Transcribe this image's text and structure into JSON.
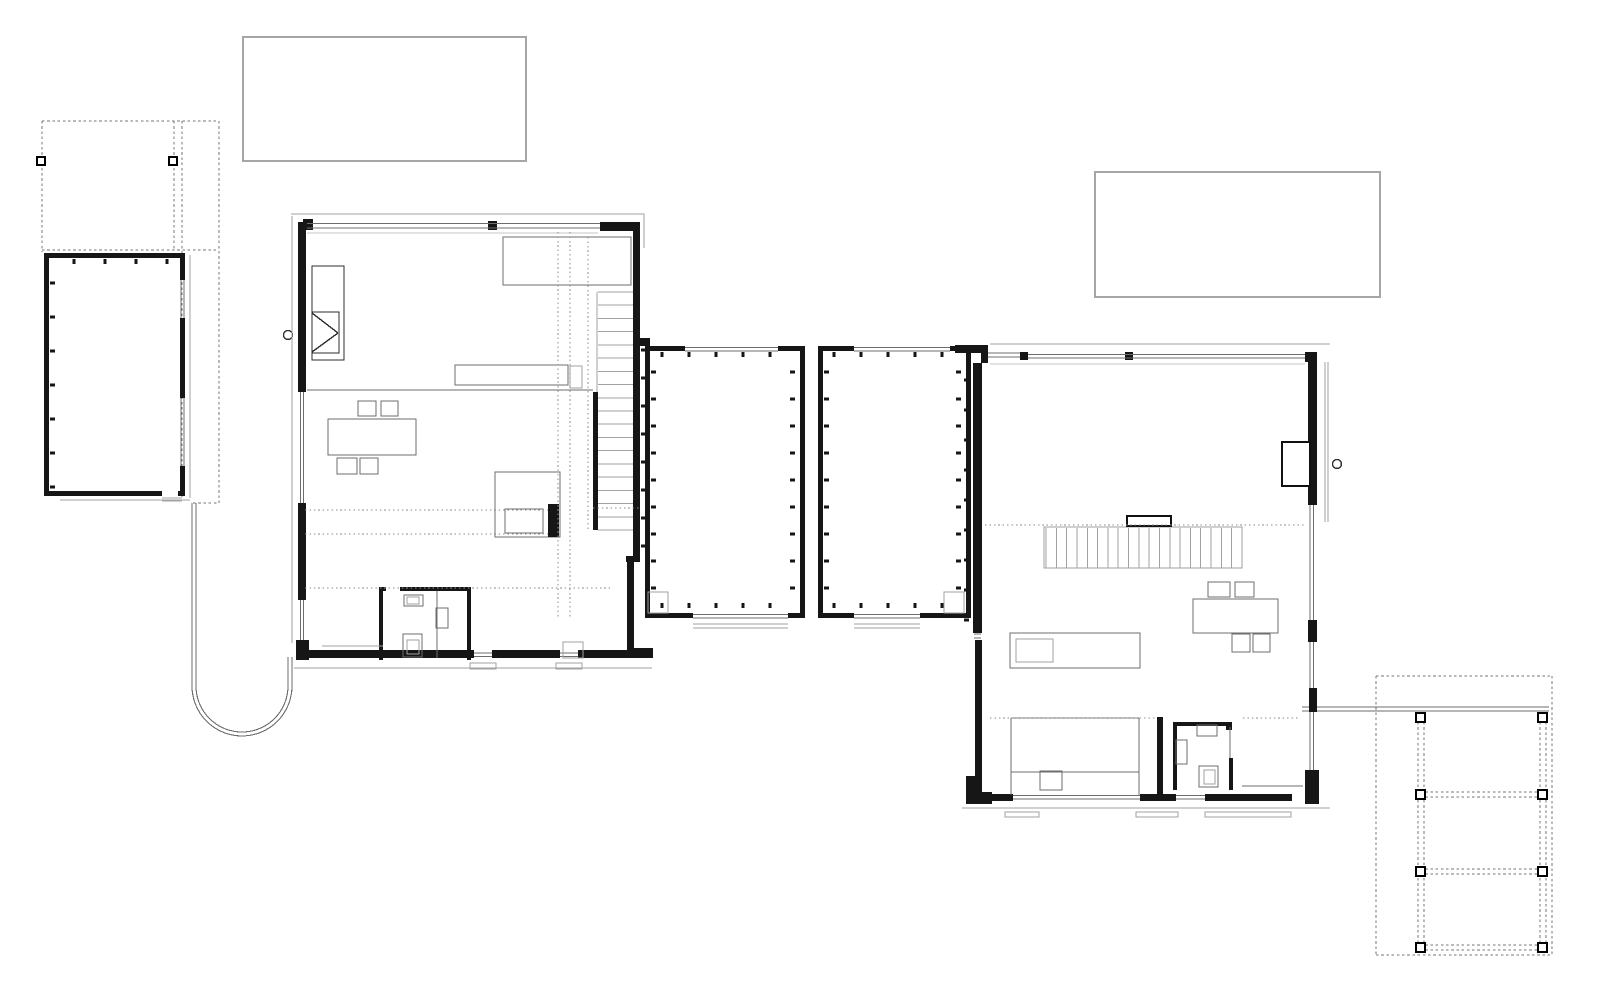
{
  "document": {
    "title": "Ground floor plan — two-wing house with glazed connector, garage and carports",
    "kind": "architectural floor plan",
    "canvas": {
      "width": 1600,
      "height": 986
    }
  },
  "colors": {
    "bg": "#ffffff",
    "wall": "#161616",
    "dark": "#2e2e2e",
    "mid": "#6d6d6d",
    "light": "#a2a2a2",
    "faint": "#c6c6c6",
    "dotted": "#8e8e8e",
    "dashed": "#757575",
    "roof": "#a6a6a6"
  },
  "inventory": {
    "roof_outlines": [
      "northwest flat-roof outline",
      "northeast flat-roof outline"
    ],
    "buildings": [
      "garage outbuilding",
      "west wing",
      "glazed connector with two court rooms",
      "east wing"
    ],
    "carport_northwest_posts": 2,
    "carport_southeast_posts": 8,
    "west_wing_features": [
      "fireplace",
      "straight stair",
      "bed",
      "wall shelf",
      "dining table with four chairs",
      "desk with chair",
      "bathroom with wc basin and shower",
      "entry mat"
    ],
    "east_wing_features": [
      "straight stair",
      "stair handrail block",
      "wardrobe",
      "kitchen island with sink",
      "dining table with four chairs",
      "bed",
      "bathroom with wc basin and shower",
      "sliding door"
    ],
    "door_handles": 2,
    "curved_passage": "U-shaped walled path between garage and west wing"
  },
  "generated": {
    "west_stair": {
      "x": 598,
      "w": 35,
      "y1": 292,
      "y2": 530,
      "treads": 19
    },
    "east_stair": {
      "y": 528,
      "h": 40,
      "x1": 1046,
      "x2": 1242,
      "treads": 20
    },
    "posts_se": {
      "cols": [
        1416,
        1538
      ],
      "rows": [
        713,
        790,
        867,
        943
      ],
      "size": 9
    },
    "posts_nw": {
      "cols": [
        37,
        169
      ],
      "rows": [
        157
      ],
      "size": 8
    },
    "ticks": [
      {
        "orient": "h",
        "y": 352,
        "from": 662,
        "to": 796,
        "step": 27,
        "dir": 1
      },
      {
        "orient": "v",
        "x": 651,
        "from": 372,
        "to": 606,
        "step": 27,
        "dir": 1
      },
      {
        "orient": "v",
        "x": 795,
        "from": 372,
        "to": 606,
        "step": 27,
        "dir": -1
      },
      {
        "orient": "h",
        "y": 608,
        "from": 662,
        "to": 796,
        "step": 27,
        "dir": -1
      },
      {
        "orient": "h",
        "y": 352,
        "from": 834,
        "to": 964,
        "step": 27,
        "dir": 1
      },
      {
        "orient": "v",
        "x": 824,
        "from": 372,
        "to": 606,
        "step": 27,
        "dir": 1
      },
      {
        "orient": "v",
        "x": 961,
        "from": 372,
        "to": 606,
        "step": 27,
        "dir": -1
      },
      {
        "orient": "h",
        "y": 608,
        "from": 834,
        "to": 964,
        "step": 27,
        "dir": -1
      },
      {
        "orient": "v",
        "x": 969,
        "from": 380,
        "to": 622,
        "step": 30,
        "dir": -1
      },
      {
        "orient": "v",
        "x": 641,
        "from": 350,
        "to": 548,
        "step": 28,
        "dir": 1
      },
      {
        "orient": "v",
        "x": 50,
        "from": 283,
        "to": 487,
        "step": 34,
        "dir": 1
      },
      {
        "orient": "h",
        "y": 259,
        "from": 74,
        "to": 172,
        "step": 31,
        "dir": 1
      }
    ],
    "dotted": [
      [
        305,
        510,
        548,
        510
      ],
      [
        593,
        508,
        640,
        508
      ],
      [
        305,
        534,
        548,
        534
      ],
      [
        305,
        588,
        613,
        588
      ],
      [
        558,
        232,
        558,
        618
      ],
      [
        570,
        232,
        570,
        618
      ],
      [
        588,
        237,
        588,
        530
      ],
      [
        985,
        525,
        1305,
        525
      ],
      [
        990,
        718,
        1155,
        718
      ],
      [
        1243,
        718,
        1300,
        718
      ]
    ],
    "dashed": [
      [
        42,
        121,
        219,
        121
      ],
      [
        42,
        121,
        42,
        252
      ],
      [
        42,
        250,
        219,
        250
      ],
      [
        219,
        121,
        219,
        503
      ],
      [
        174,
        121,
        174,
        250
      ],
      [
        182,
        121,
        182,
        497
      ],
      [
        193,
        503,
        219,
        503
      ],
      [
        1376,
        676,
        1552,
        676
      ],
      [
        1376,
        676,
        1376,
        955
      ],
      [
        1376,
        955,
        1552,
        955
      ],
      [
        1552,
        676,
        1552,
        955
      ],
      [
        1418,
        722,
        1418,
        943
      ],
      [
        1424,
        722,
        1424,
        943
      ],
      [
        1540,
        722,
        1540,
        943
      ],
      [
        1546,
        722,
        1546,
        943
      ],
      [
        1420,
        792,
        1545,
        792
      ],
      [
        1420,
        797,
        1545,
        797
      ],
      [
        1420,
        869,
        1545,
        869
      ],
      [
        1420,
        874,
        1545,
        874
      ],
      [
        1420,
        945,
        1545,
        945
      ],
      [
        1420,
        950,
        1545,
        950
      ]
    ]
  }
}
